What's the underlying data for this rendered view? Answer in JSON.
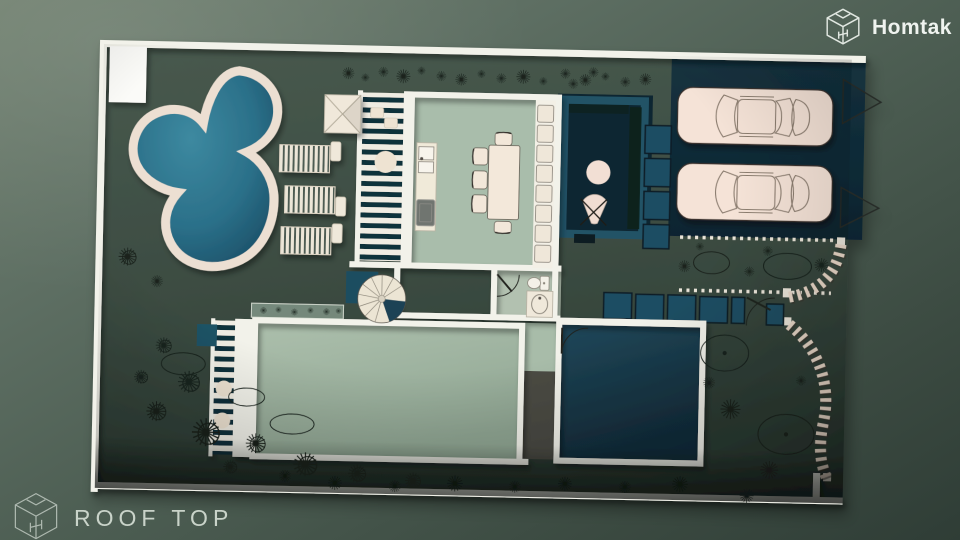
{
  "brand": {
    "name": "Homtak",
    "logo_icon": "homtak-cube-logo-icon"
  },
  "plan": {
    "label": "ROOF TOP",
    "logo_icon": "homtak-cube-outline-icon"
  },
  "floor_plan": {
    "view": "roof-top-architectural-plan",
    "elements": [
      {
        "name": "free-form-pool",
        "count": 1
      },
      {
        "name": "pool-deck-rim",
        "count": 1
      },
      {
        "name": "sun-lounger",
        "count": 3
      },
      {
        "name": "pyramid-skylight",
        "count": 1
      },
      {
        "name": "louvered-pergola-strip",
        "count": 2
      },
      {
        "name": "kitchen-counter-sink-stove",
        "count": 1
      },
      {
        "name": "dining-table",
        "count": 1
      },
      {
        "name": "dining-chair",
        "count": 5
      },
      {
        "name": "bench-cushion",
        "count": 8
      },
      {
        "name": "spiral-staircase",
        "count": 1
      },
      {
        "name": "bathroom-toilet",
        "count": 1
      },
      {
        "name": "bathroom-washbasin",
        "count": 1
      },
      {
        "name": "courtyard-round-table",
        "count": 1
      },
      {
        "name": "courtyard-chair",
        "count": 1
      },
      {
        "name": "parked-car",
        "count": 2
      },
      {
        "name": "gate-swing-triangle",
        "count": 2
      },
      {
        "name": "stepping-tile",
        "count": 10
      },
      {
        "name": "dotted-planting-bed",
        "count": 1
      },
      {
        "name": "curved-slat-path",
        "count": 2
      },
      {
        "name": "garden-tree-shrub",
        "count": 30
      }
    ]
  },
  "colors": {
    "background_outer": "#5b6c60",
    "site_ground": "#42524833",
    "pool_water": "#2f7a93",
    "pool_rim": "#ecdfd2",
    "walls": "#f2f2ea",
    "floor_sage": "#a9bdab",
    "room_teal_dark": "#1d4254",
    "parking_teal": "#132f3c",
    "court_floor": "#0d2733",
    "car_body": "#f5e3d7",
    "tile_teal": "#1f4e63",
    "furniture_cream": "#f1e6d8",
    "plant_line": "#1a231d",
    "brand_text": "#eff3ef",
    "plan_text": "#c9d3c9"
  }
}
